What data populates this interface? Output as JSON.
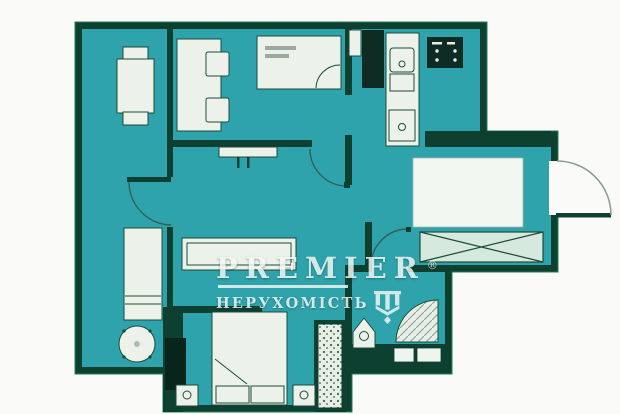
{
  "watermark": {
    "brand": "PREMIER",
    "registered": "®",
    "subtitle": "НЕРУХОМІСТЬ"
  },
  "colors": {
    "background": "#fafaf8",
    "floor": "#2ca4ad",
    "wall": "#0d4032",
    "wall-dark": "#07251c",
    "wall-edge": "#1f8156",
    "furniture": "#ecf2e9",
    "furniture-edge": "#1c4a3b",
    "appliance": "#0e2c24",
    "swing": "#8a9e96",
    "swing2": "#2f6152",
    "watermark": "#f2f7f4",
    "smudge": "#5a6e68",
    "dots-bg": "#e7efe4",
    "dot": "#44604f",
    "hatch": "#8fa89b"
  }
}
